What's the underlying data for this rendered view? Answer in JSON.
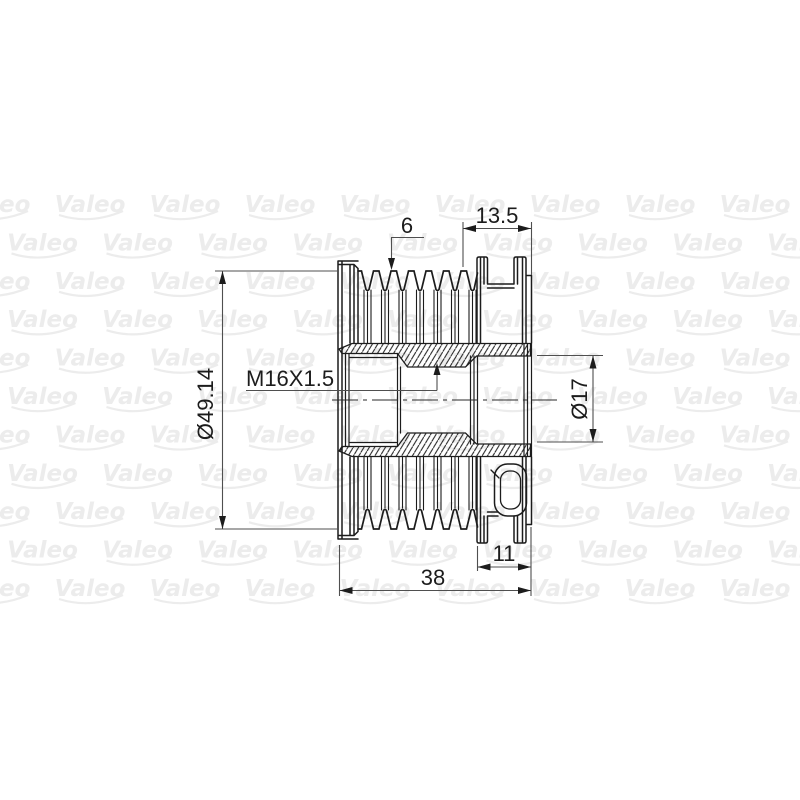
{
  "watermark": {
    "label": "Valeo",
    "color": "#ececec"
  },
  "colors": {
    "background": "#ffffff",
    "drawing_line": "#1c1c1c",
    "dimension_line": "#4f4f4f",
    "text": "#1c1c1c"
  },
  "dimensions": {
    "belt_grooves": "6",
    "front_section_width": "13.5",
    "outer_diameter": "Ø49.14",
    "thread_spec": "M16X1.5",
    "bore_diameter": "Ø17",
    "rear_hub_width": "11",
    "overall_width": "38"
  }
}
